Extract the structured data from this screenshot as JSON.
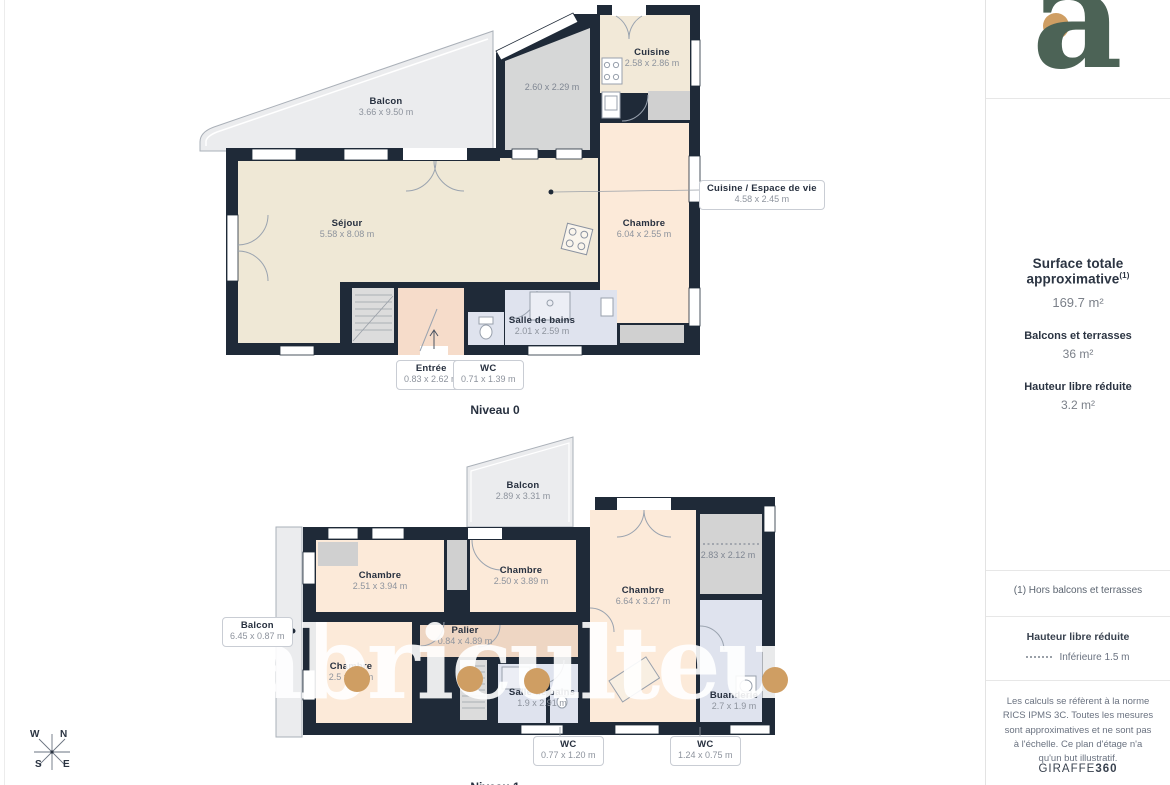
{
  "niveau0": {
    "title": "Niveau 0",
    "rooms": {
      "balcon": {
        "name": "Balcon",
        "dims": "3.66 x 9.50 m"
      },
      "gray": {
        "dims": "2.60 x 2.29 m"
      },
      "cuisine": {
        "name": "Cuisine",
        "dims": "2.58 x 2.86 m"
      },
      "sejour": {
        "name": "Séjour",
        "dims": "5.58 x 8.08 m"
      },
      "chambre": {
        "name": "Chambre",
        "dims": "6.04 x 2.55 m"
      },
      "sdb": {
        "name": "Salle de bains",
        "dims": "2.01 x 2.59 m"
      }
    },
    "callouts": {
      "espace": {
        "name": "Cuisine / Espace de vie",
        "dims": "4.58 x 2.45 m"
      },
      "entree": {
        "name": "Entrée",
        "dims": "0.83 x 2.62 m"
      },
      "wc": {
        "name": "WC",
        "dims": "0.71 x 1.39 m"
      }
    }
  },
  "niveau1": {
    "title": "Niveau 1",
    "rooms": {
      "balcon": {
        "name": "Balcon",
        "dims": "2.89 x 3.31 m"
      },
      "chambre_a": {
        "name": "Chambre",
        "dims": "2.51 x 3.94 m"
      },
      "chambre_b": {
        "name": "Chambre",
        "dims": "2.50 x 3.89 m"
      },
      "chambre_c": {
        "name": "Chambre",
        "dims": "6.64 x 3.27 m"
      },
      "gray": {
        "dims": "2.83 x 2.12 m"
      },
      "palier": {
        "name": "Palier",
        "dims": "0.84 x 4.89 m"
      },
      "chambre_d": {
        "name": "Chambre",
        "dims": "2.5 x 3.4 m"
      },
      "sdb": {
        "name": "Salle de bains",
        "dims": "1.9 x 2.91 m"
      },
      "buanderie": {
        "name": "Buanderie",
        "dims": "2.7 x 1.9 m"
      }
    },
    "callouts": {
      "balcon_gauche": {
        "name": "Balcon",
        "dims": "6.45 x 0.87 m"
      },
      "wc1": {
        "name": "WC",
        "dims": "0.77 x 1.20 m"
      },
      "wc2": {
        "name": "WC",
        "dims": "1.24 x 0.75 m"
      }
    }
  },
  "compass": {
    "n": "N",
    "s": "S",
    "e": "E",
    "w": "W"
  },
  "watermark": "abriculteur",
  "sidebar": {
    "logo_letter": "a",
    "surface_title": "Surface totale approximative",
    "surface_sup": "(1)",
    "surface_value": "169.7 m²",
    "balcons_label": "Balcons et terrasses",
    "balcons_value": "36 m²",
    "hauteur_label": "Hauteur libre réduite",
    "hauteur_value": "3.2 m²",
    "footnote": "(1) Hors balcons et terrasses",
    "legend_title": "Hauteur libre réduite",
    "legend_value": "Inférieure 1.5 m",
    "legal": "Les calculs se réfèrent à la norme RICS IPMS 3C. Toutes les mesures sont approximatives et ne sont pas à l'échelle. Ce plan d'étage n'a qu'un but illustratif.",
    "brand": "GIRAFFE",
    "brand_bold": "360"
  },
  "colors": {
    "wall": "#1f2a38",
    "accent_orange": "#cf9e63",
    "logo_green": "#4c6356"
  }
}
